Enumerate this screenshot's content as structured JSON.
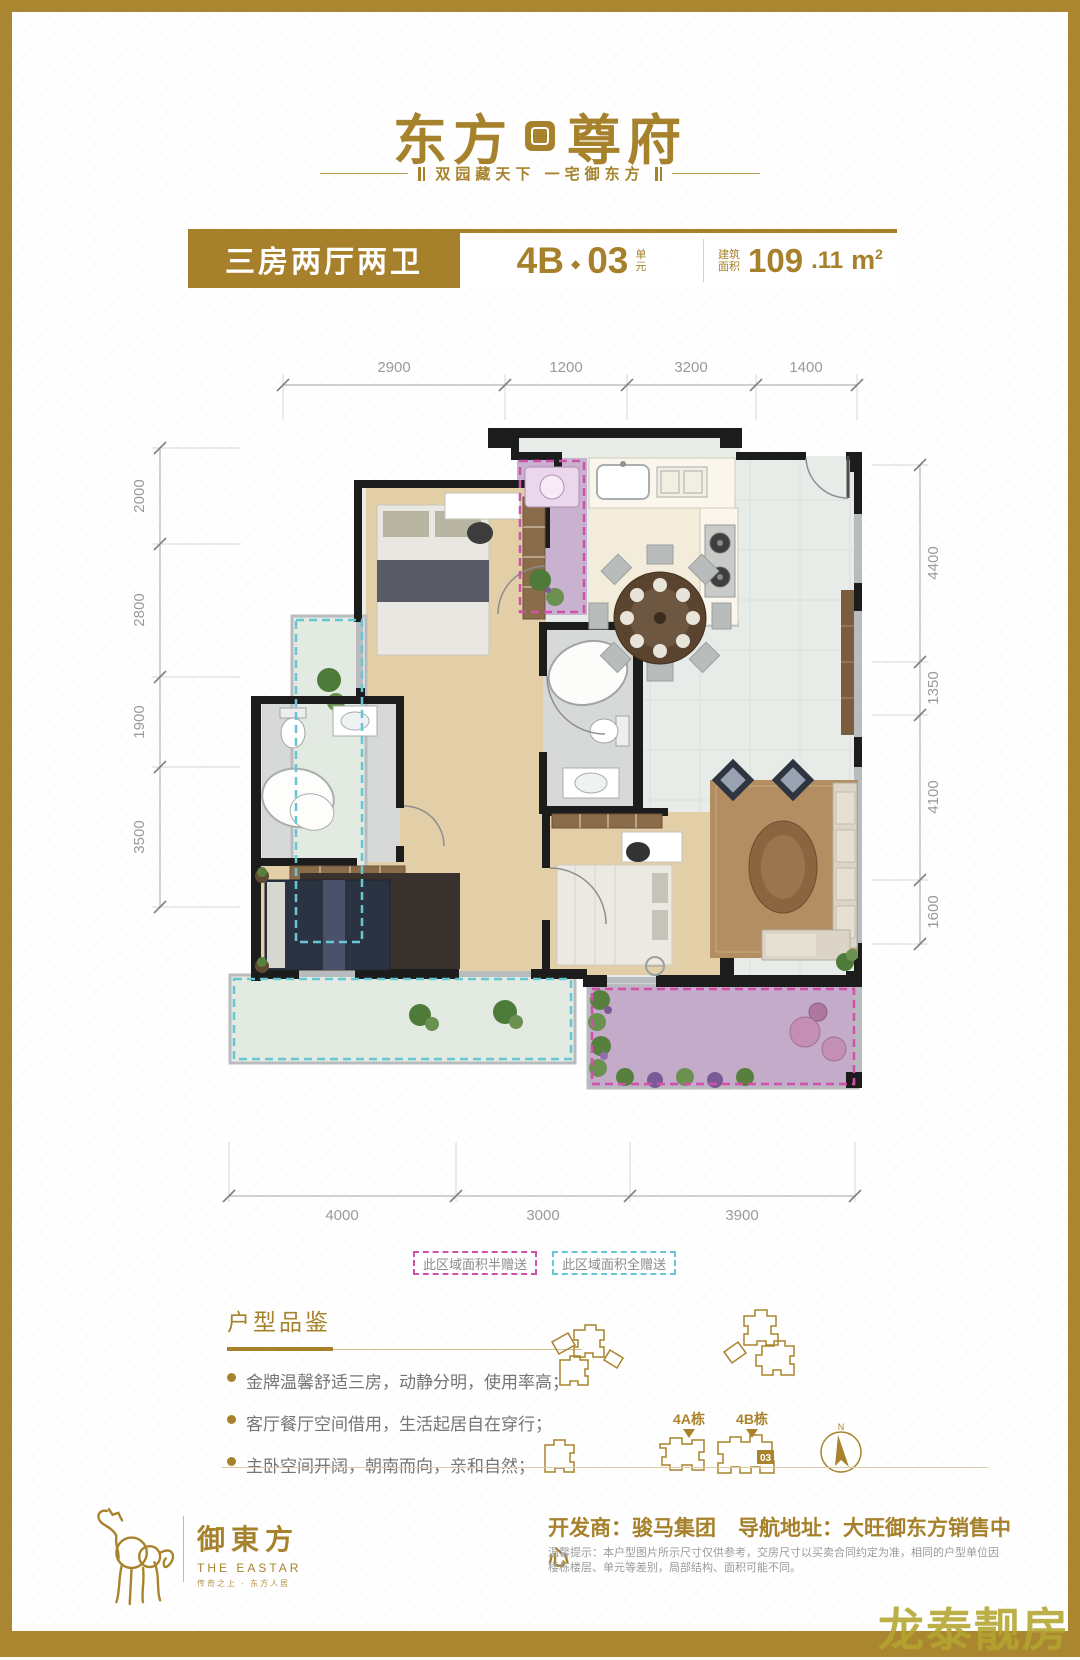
{
  "brand": {
    "name_left": "东方",
    "name_right": "尊府",
    "tagline": "双园藏天下  一宅御东方"
  },
  "spec_bar": {
    "type_label": "三房两厅两卫",
    "unit_code": "4B",
    "unit_sep": "◆",
    "unit_number": "03",
    "unit_suffix_top": "单",
    "unit_suffix_bottom": "元",
    "area_label_top": "建筑",
    "area_label_bottom": "面积",
    "area_int": "109",
    "area_dec": ".11",
    "area_unit": "m",
    "area_sup": "2"
  },
  "dims": {
    "top": [
      "2900",
      "1200",
      "3200",
      "1400"
    ],
    "left": [
      "2000",
      "2800",
      "1900",
      "3500"
    ],
    "right": [
      "4400",
      "1350",
      "4100",
      "1600"
    ],
    "bottom": [
      "4000",
      "3000",
      "3900"
    ]
  },
  "legend": {
    "half": "此区域面积半赠送",
    "full": "此区域面积全赠送"
  },
  "features": {
    "title": "户型品鉴",
    "items": [
      "金牌温馨舒适三房，动静分明，使用率高；",
      "客厅餐厅空间借用，生活起居自在穿行；",
      "主卧空间开阔，朝南而向，亲和自然；"
    ]
  },
  "siteplan": {
    "label_4a": "4A栋",
    "label_4b": "4B栋",
    "unit_badge": "03",
    "compass_n": "N"
  },
  "footer": {
    "logo_cn": "御東方",
    "logo_en": "THE EASTAR",
    "logo_sub": "传奇之上 · 东方人居",
    "developer": "开发商：骏马集团",
    "address": "导航地址：大旺御东方销售中心",
    "disclaimer": "温馨提示：本户型图片所示尺寸仅供参考，交房尺寸以买卖合同约定为准，相同的户型单位因楼栋楼层、单元等差别，局部结构、面积可能不同。"
  },
  "watermark": "龙泰靓房",
  "colors": {
    "gold": "#a7822c",
    "half_gift": "#cf52a8",
    "full_gift": "#66c6d4"
  }
}
